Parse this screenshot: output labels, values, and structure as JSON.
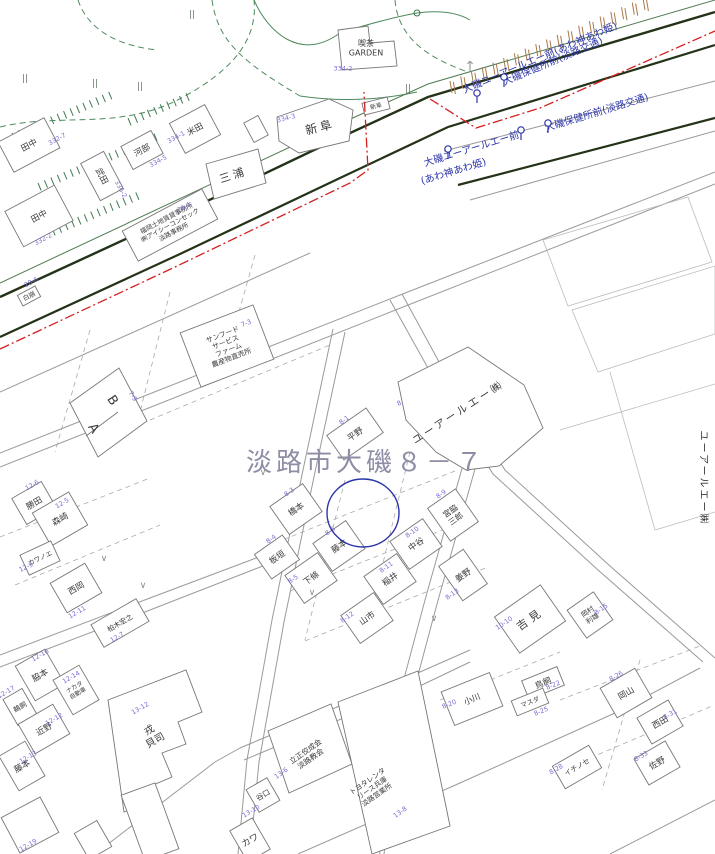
{
  "map_title": {
    "text": "淡路市大磯８－７",
    "x": 246,
    "y": 462,
    "font_size": 26,
    "letter_spacing": 4,
    "color": "#8d8da6"
  },
  "highlight_circle": {
    "x": 363,
    "y": 513,
    "rx": 36,
    "ry": 34,
    "color": "#2c35a8"
  },
  "palette": {
    "name_color": "#3a3a3a",
    "lot_color": "#7b6fd4",
    "bus_color": "#2c35a8",
    "boundary_red": "#d42020",
    "road_dark": "#243318",
    "green": "#4e8a5c",
    "hachure_brown": "#a87848",
    "parking_green": "#3f7a50"
  },
  "buildings": [
    {
      "name": "田中",
      "lot": "332-7",
      "x": 29,
      "y": 145,
      "rot": -28,
      "box": [
        52,
        34
      ],
      "lot_x": 57,
      "lot_y": 139
    },
    {
      "name": "河部",
      "lot": "334-5",
      "x": 142,
      "y": 150,
      "rot": -28,
      "box": [
        34,
        26
      ],
      "lot_x": 158,
      "lot_y": 161
    },
    {
      "name": "米田",
      "lot": "334-1",
      "x": 195,
      "y": 129,
      "rot": -28,
      "box": [
        40,
        34
      ],
      "lot_x": 176,
      "lot_y": 137
    },
    {
      "name": "武田",
      "lot": "336-2",
      "x": 102,
      "y": 176,
      "rot": 62,
      "brot": -28,
      "box": [
        26,
        42
      ],
      "lot_x": 121,
      "lot_y": 189
    },
    {
      "name": "田中",
      "lot": "332-2",
      "x": 39,
      "y": 216,
      "rot": -28,
      "box": [
        56,
        40
      ],
      "lot_x": 43,
      "lot_y": 239
    },
    {
      "name": "三浦",
      "x": 233,
      "y": 175,
      "rot": -18,
      "fs": 11,
      "ls": 3
    },
    {
      "name": "新阜",
      "lot": "334-3",
      "x": 320,
      "y": 127,
      "rot": -14,
      "fs": 12,
      "ls": 3,
      "lot_x": 286,
      "lot_y": 118
    },
    {
      "name": "新阜",
      "x": 376,
      "y": 106,
      "rot": -14,
      "fs": 6,
      "box": [
        26,
        12
      ]
    },
    {
      "name": "喫茶GARDEN",
      "lines": [
        "喫茶",
        "GARDEN"
      ],
      "lot": "334-2",
      "x": 366,
      "y": 48,
      "rot": 0,
      "fs": 8,
      "lot_x": 343,
      "lot_y": 68
    },
    {
      "name": "福岡土地賃貸事務所",
      "lines": [
        "福岡土地賃貸事務所",
        "㈱アイシーコンセック",
        "淡路事務所"
      ],
      "lot": "26-1",
      "x": 170,
      "y": 225,
      "rot": -28,
      "fs": 6.5,
      "box": [
        90,
        34
      ],
      "lot_x": 184,
      "lot_y": 207
    },
    {
      "name": "白崩",
      "lot": "28-6",
      "x": 29,
      "y": 296,
      "rot": -28,
      "fs": 6.5,
      "box": [
        20,
        12
      ],
      "lot_x": 31,
      "lot_y": 282
    },
    {
      "name": "サンフードサービスファーム",
      "lines": [
        "サンフード",
        "サービス",
        "ファーム",
        "農産物直売所"
      ],
      "lot": "7-3",
      "x": 227,
      "y": 346,
      "rot": -21,
      "fs": 7,
      "box": [
        78,
        58
      ],
      "lot_x": 246,
      "lot_y": 323
    },
    {
      "name": "B",
      "lot": "7-9",
      "x": 113,
      "y": 400,
      "rot": 57,
      "fs": 13,
      "lot_x": 133,
      "lot_y": 396
    },
    {
      "name": "A",
      "x": 94,
      "y": 428,
      "rot": 57,
      "fs": 13
    },
    {
      "name": "ユーアールエー㈱",
      "x": 458,
      "y": 412,
      "rot": -33,
      "fs": 10.5,
      "ls": 3
    },
    {
      "name": "平野",
      "lot": "8-1",
      "x": 355,
      "y": 434,
      "rot": -35,
      "box": [
        48,
        30
      ],
      "lot_x": 344,
      "lot_y": 420
    },
    {
      "name": "橋本",
      "lot": "8-3",
      "x": 296,
      "y": 509,
      "rot": -35,
      "box": [
        40,
        34
      ],
      "lot_x": 289,
      "lot_y": 492
    },
    {
      "name": "藤本",
      "lot": "8-6",
      "x": 339,
      "y": 546,
      "rot": -35,
      "box": [
        40,
        34
      ],
      "lot_x": 330,
      "lot_y": 531
    },
    {
      "name": "板垣",
      "lot": "8-4",
      "x": 277,
      "y": 557,
      "rot": -35,
      "box": [
        34,
        30
      ],
      "lot_x": 271,
      "lot_y": 539
    },
    {
      "name": "下條",
      "lot": "8-5",
      "x": 311,
      "y": 578,
      "rot": -35,
      "box": [
        40,
        34
      ],
      "lot_x": 293,
      "lot_y": 579
    },
    {
      "name": "中谷",
      "lot": "8-10",
      "x": 416,
      "y": 544,
      "rot": -35,
      "box": [
        40,
        34
      ],
      "lot_x": 412,
      "lot_y": 532
    },
    {
      "name": "稲井",
      "lot": "8-11",
      "x": 390,
      "y": 579,
      "rot": -35,
      "box": [
        40,
        34
      ],
      "lot_x": 386,
      "lot_y": 567
    },
    {
      "name": "山市",
      "lot": "8-12",
      "x": 367,
      "y": 618,
      "rot": -35,
      "box": [
        40,
        34
      ],
      "lot_x": 347,
      "lot_y": 617
    },
    {
      "name": "宮脇三郎",
      "lines": [
        "宮脇",
        "三郎"
      ],
      "lot": "8-9",
      "x": 453,
      "y": 515,
      "rot": -35,
      "fs": 8,
      "box": [
        34,
        40
      ],
      "lot_x": 441,
      "lot_y": 494
    },
    {
      "name": "姜野",
      "lot": "8-13",
      "x": 463,
      "y": 575,
      "rot": -35,
      "box": [
        30,
        42
      ],
      "lot_x": 452,
      "lot_y": 594
    },
    {
      "name": "吉見",
      "lot": "10-10",
      "x": 530,
      "y": 619,
      "rot": -35,
      "fs": 11,
      "ls": 4,
      "box": [
        56,
        44
      ],
      "lot_x": 504,
      "lot_y": 623
    },
    {
      "name": "岡村利雄",
      "lines": [
        "岡村",
        "利雄"
      ],
      "lot": "8-15",
      "x": 590,
      "y": 615,
      "rot": -35,
      "fs": 7,
      "box": [
        32,
        34
      ],
      "lot_x": 601,
      "lot_y": 609
    },
    {
      "name": "小川",
      "lot": "8-20",
      "x": 472,
      "y": 699,
      "rot": -22,
      "box": [
        52,
        36
      ],
      "lot_x": 449,
      "lot_y": 704
    },
    {
      "name": "鳥飼",
      "lot": "8-22",
      "x": 543,
      "y": 683,
      "rot": -22,
      "box": [
        38,
        20
      ],
      "lot_x": 553,
      "lot_y": 685
    },
    {
      "name": "マスダ",
      "lot": "8-25",
      "x": 530,
      "y": 702,
      "rot": -22,
      "fs": 6.5,
      "box": [
        34,
        16
      ],
      "lot_x": 541,
      "lot_y": 711
    },
    {
      "name": "岡山",
      "lot": "8-26",
      "x": 626,
      "y": 693,
      "rot": -30,
      "box": [
        40,
        34
      ],
      "lot_x": 616,
      "lot_y": 676
    },
    {
      "name": "西田",
      "lot": "8-31",
      "x": 660,
      "y": 722,
      "rot": -30,
      "box": [
        36,
        30
      ],
      "lot_x": 670,
      "lot_y": 714
    },
    {
      "name": "イチノセ",
      "lot": "8-28",
      "x": 577,
      "y": 767,
      "rot": -30,
      "fs": 7,
      "box": [
        42,
        26
      ],
      "lot_x": 556,
      "lot_y": 769
    },
    {
      "name": "佐野",
      "lot": "8-33",
      "x": 657,
      "y": 763,
      "rot": -30,
      "box": [
        36,
        30
      ],
      "lot_x": 641,
      "lot_y": 756
    },
    {
      "name": "勝田",
      "lot": "12-6",
      "x": 34,
      "y": 503,
      "rot": -30,
      "box": [
        34,
        30
      ],
      "lot_x": 32,
      "lot_y": 485
    },
    {
      "name": "森崎",
      "lot": "12-5",
      "x": 60,
      "y": 519,
      "rot": -30,
      "box": [
        42,
        38
      ],
      "lot_x": 62,
      "lot_y": 503
    },
    {
      "name": "カワノエ",
      "lot": "12-9",
      "x": 40,
      "y": 558,
      "rot": -25,
      "fs": 6.5,
      "box": [
        34,
        22
      ],
      "lot_x": 26,
      "lot_y": 567
    },
    {
      "name": "西岡",
      "lot": "12-11",
      "x": 76,
      "y": 588,
      "rot": -30,
      "box": [
        40,
        34
      ],
      "lot_x": 77,
      "lot_y": 612
    },
    {
      "name": "柏木宏之",
      "lot": "12-7",
      "x": 120,
      "y": 623,
      "rot": -30,
      "fs": 7,
      "box": [
        52,
        26
      ],
      "lot_x": 117,
      "lot_y": 637
    },
    {
      "name": "脇本",
      "lot": "12-16",
      "x": 40,
      "y": 675,
      "rot": -30,
      "box": [
        34,
        40
      ],
      "lot_x": 40,
      "lot_y": 655
    },
    {
      "name": "ナカタ自動車",
      "lines": [
        "ナカタ",
        "自動車"
      ],
      "lot": "12-14",
      "x": 76,
      "y": 690,
      "rot": -30,
      "fs": 6,
      "box": [
        30,
        40
      ],
      "lot_x": 71,
      "lot_y": 677
    },
    {
      "name": "鵜飼",
      "lot": "12-17",
      "x": 20,
      "y": 707,
      "rot": -30,
      "fs": 7,
      "box": [
        22,
        30
      ],
      "lot_x": 6,
      "lot_y": 692
    },
    {
      "name": "近野",
      "lot": "12-12",
      "x": 44,
      "y": 729,
      "rot": -30,
      "box": [
        40,
        34
      ],
      "lot_x": 54,
      "lot_y": 719
    },
    {
      "name": "藤本",
      "lot": "12-13",
      "x": 22,
      "y": 766,
      "rot": -30,
      "box": [
        30,
        40
      ],
      "lot_x": 28,
      "lot_y": 757
    },
    {
      "name": "戎貝司",
      "lines": [
        "戎",
        "貝司"
      ],
      "lot": "13-12",
      "x": 152,
      "y": 735,
      "rot": -30,
      "fs": 10,
      "lot_x": 140,
      "lot_y": 708
    },
    {
      "name": "立正佼成会淡路教会",
      "lines": [
        "立正佼成会",
        "淡路教会"
      ],
      "lot": "13-6",
      "x": 308,
      "y": 755,
      "rot": -35,
      "fs": 7.5,
      "lot_x": 281,
      "lot_y": 773
    },
    {
      "name": "谷口",
      "lot": "13-10",
      "x": 263,
      "y": 795,
      "rot": -30,
      "fs": 7.5,
      "box": [
        24,
        26
      ],
      "lot_x": 251,
      "lot_y": 811
    },
    {
      "name": "トヨタレンタリース兵庫 淡路営業所",
      "lines": [
        "トヨタレンタ",
        "リース兵庫",
        "淡路営業所"
      ],
      "lot": "13-8",
      "x": 372,
      "y": 788,
      "rot": -35,
      "fs": 7,
      "lot_x": 400,
      "lot_y": 812
    },
    {
      "name": "カワ",
      "x": 250,
      "y": 840,
      "rot": -30,
      "fs": 9,
      "box": [
        26,
        36
      ]
    },
    {
      "name": "ユーアールエー㈱",
      "x": 704,
      "y": 478,
      "rot": 90,
      "fs": 10,
      "ls": 2
    }
  ],
  "extra_lots": [
    {
      "text": "8",
      "x": 399,
      "y": 403
    },
    {
      "text": "12-19",
      "x": 28,
      "y": 845
    }
  ],
  "bus": {
    "labels": [
      {
        "text": "大磯ユーアールエー前(あわ神あわ姫)",
        "x": 463,
        "y": 90,
        "rot": -23
      },
      {
        "text": "大磯保健所前(淡路交通)",
        "x": 503,
        "y": 82,
        "rot": -23
      },
      {
        "text": "大磯保健所前(淡路交通)",
        "x": 545,
        "y": 128,
        "rot": -17
      },
      {
        "text": "大磯ユーアールエー前",
        "x": 424,
        "y": 163,
        "rot": -17
      },
      {
        "text": "(あわ神あわ姫)",
        "x": 421,
        "y": 181,
        "rot": -17
      }
    ],
    "icons": [
      {
        "x": 477,
        "y": 93
      },
      {
        "x": 504,
        "y": 77
      },
      {
        "x": 521,
        "y": 130
      },
      {
        "x": 548,
        "y": 123
      },
      {
        "x": 448,
        "y": 149
      }
    ]
  },
  "symbols": {
    "paddy_marks": [
      [
        25,
        78
      ],
      [
        95,
        83
      ],
      [
        140,
        86
      ],
      [
        192,
        14
      ],
      [
        408,
        88
      ]
    ],
    "grass_marks": [
      [
        263,
        472
      ],
      [
        312,
        592
      ],
      [
        434,
        618
      ],
      [
        104,
        558
      ],
      [
        143,
        585
      ]
    ],
    "north_arrow": {
      "x": 470,
      "y": 66,
      "glyph": "↑"
    },
    "small_circle": {
      "x": 417,
      "y": 13
    }
  }
}
